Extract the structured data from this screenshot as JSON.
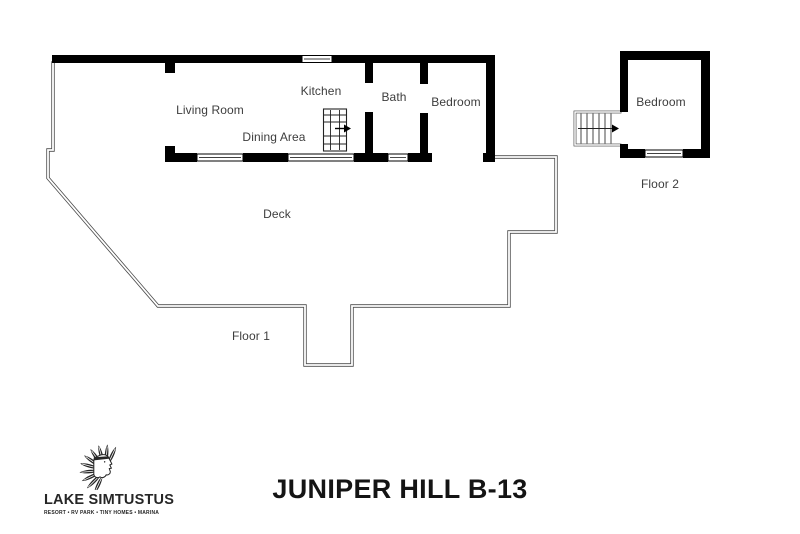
{
  "meta": {
    "background": "#ffffff",
    "wall_color": "#000000",
    "deck_line_color": "#4a4a4a",
    "label_color": "#3d3d3d",
    "icons": {
      "floor1_stairs": "stairs-icon",
      "floor2_stairs": "stairs-icon",
      "stair_arrows": "arrow-right-icon",
      "brand_mark": "chief-headdress-icon"
    }
  },
  "plan": {
    "floor1": {
      "label": "Floor 1",
      "rooms": {
        "living_room": "Living Room",
        "kitchen": "Kitchen",
        "dining_area": "Dining Area",
        "bath": "Bath",
        "bedroom": "Bedroom",
        "deck": "Deck"
      }
    },
    "floor2": {
      "label": "Floor 2",
      "rooms": {
        "bedroom": "Bedroom"
      }
    }
  },
  "footer": {
    "unit_title": "JUNIPER HILL B-13",
    "brand": {
      "name": "LAKE SIMTUSTUS",
      "tagline": "RESORT • RV PARK • TINY HOMES • MARINA"
    }
  }
}
